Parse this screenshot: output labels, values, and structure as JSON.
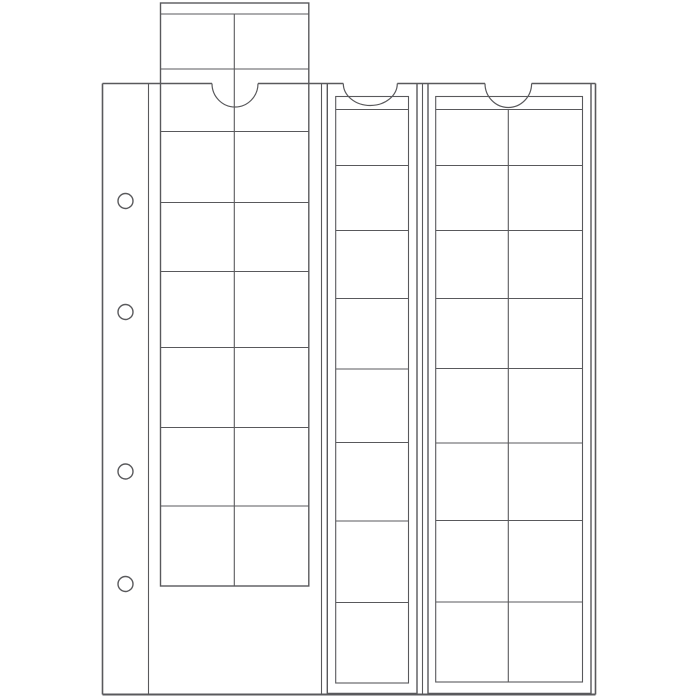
{
  "canvas": {
    "width": 700,
    "height": 700,
    "background": "#ffffff"
  },
  "style": {
    "line_color": "#59595c",
    "thin_line_color": "#68686b",
    "sheet_fill": "#ffffff",
    "page_stroke_width": 1.6,
    "sheet_stroke_width": 1.4,
    "grid_stroke_width": 1.1
  },
  "illustration": {
    "subject": "ring-binder coin album page with three slide-in coin pocket strips, left strip pulled out",
    "binder_page": {
      "x": 102.5,
      "y": 83.5,
      "right": 595.5,
      "bottom": 694.5,
      "margin_line_x": 148.5,
      "pocket_seam_x": [
        321.5,
        422.5
      ],
      "binder_holes": {
        "cx": 125.5,
        "r": 7.5,
        "cy": [
          201,
          312,
          471.5,
          584
        ]
      },
      "thumb_notches": [
        {
          "pocket": "left",
          "cx": 235.0,
          "rx": 23.0,
          "ry": 23.5
        },
        {
          "pocket": "middle",
          "cx": 370.3,
          "rx": 27.0,
          "ry": 22.0
        },
        {
          "pocket": "right",
          "cx": 508.3,
          "rx": 23.3,
          "ry": 24.0
        }
      ]
    },
    "strips": [
      {
        "name": "coin-strip-left",
        "pulled_out": true,
        "pockets": {
          "cols": 2,
          "rows": 8
        },
        "sheet": {
          "x": 160.5,
          "y": 3,
          "right": 308.8,
          "bottom": 586,
          "open_top": false
        },
        "seam_y": 14,
        "grid": {
          "left": 160.5,
          "right": 308.8,
          "top": 14,
          "bottom": 586,
          "col_x": [
            234.3
          ],
          "row_y": [
            69,
            131.5,
            202.5,
            271.5,
            347.5,
            427.5,
            506
          ]
        }
      },
      {
        "name": "coin-strip-middle",
        "pulled_out": false,
        "pockets": {
          "cols": 1,
          "rows": 8
        },
        "sheet": {
          "x": 327.3,
          "y": 83.5,
          "right": 417,
          "bottom": 693.5,
          "open_top": true
        },
        "inner": {
          "x": 335.7,
          "y": 96.5,
          "right": 408.5,
          "bottom": 683
        },
        "seam_y": 109.5,
        "grid": {
          "left": 335.7,
          "right": 408.5,
          "top": 109.5,
          "bottom": 683,
          "col_x": [],
          "row_y": [
            165.5,
            230.5,
            298.5,
            369,
            442.5,
            521,
            602.5
          ]
        }
      },
      {
        "name": "coin-strip-right",
        "pulled_out": false,
        "pockets": {
          "cols": 2,
          "rows": 8
        },
        "sheet": {
          "x": 428,
          "y": 83.5,
          "right": 591,
          "bottom": 693.5,
          "open_top": true
        },
        "inner": {
          "x": 435.7,
          "y": 96.5,
          "right": 582.5,
          "bottom": 682
        },
        "seam_y": 109.5,
        "grid": {
          "left": 435.7,
          "right": 582.5,
          "top": 109.5,
          "bottom": 682,
          "col_x": [
            508.3
          ],
          "row_y": [
            165.5,
            230.5,
            298.5,
            368.5,
            443,
            520.5,
            602
          ]
        }
      }
    ]
  }
}
